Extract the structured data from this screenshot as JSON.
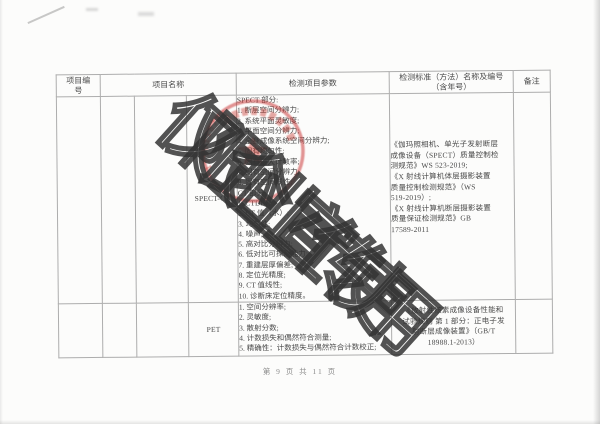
{
  "page": {
    "watermark": "仅限企业宣传使用",
    "footer": "第 9 页 共 11 页"
  },
  "table": {
    "headers": {
      "project_no": "项目编号",
      "project_name": "项目名称",
      "parameters": "检测项目参数",
      "standard": "检测标准（方法）名称及编号（含年号）",
      "remarks": "备注"
    },
    "rows": [
      {
        "name": "SPECT-CT",
        "parameters": [
          "SPECT 部分:",
          "1. 断层空间分辨力;",
          "2. 系统平面灵敏度;",
          "3. 平面空间分辨力;",
          "4. 全身成像系统空间分辨力;",
          "5. 固有均匀性;",
          "6. 固有最大计数率;",
          "7. 固有空间分辨力;",
          "8. 固有空间线性;",
          "CT 部分:",
          "1. CTDIw;",
          "2. CT 值（水）;",
          "3. 均匀性;",
          "4. 噪声;",
          "5. 高对比分辨力;",
          "6. 低对比可探测能力;",
          "7. 重建层厚偏差;",
          "8. 定位光精度;",
          "9. CT 值线性;",
          "10. 诊断床定位精度。"
        ],
        "standards": [
          "《伽玛照相机、单光子发射断层",
          "成像设备（SPECT）质量控制检",
          "测规范》WS 523-2019;",
          "《X 射线计算机体层摄影装置",
          "质量控制检测规范》（WS",
          "519-2019）;",
          "《X 射线计算机断层摄影装置",
          "质量保证检测规范》GB",
          "17589-2011"
        ],
        "remarks": ""
      },
      {
        "name": "PET",
        "parameters": [
          "1. 空间分辨率;",
          "2. 灵敏度;",
          "3. 散射分数;",
          "4. 计数损失和偶然符合测量;",
          "5. 精确性：计数损失与偶然符合计数校正;"
        ],
        "standards": [
          "《放射性核素成像设备性能和",
          "试验规则 第 1 部分：正电子发",
          "射断层成像装置》（GB/T",
          "18988.1-2013）"
        ],
        "remarks": ""
      }
    ]
  },
  "stamp": {
    "serial": "1790118756",
    "color": "#c62c24"
  }
}
